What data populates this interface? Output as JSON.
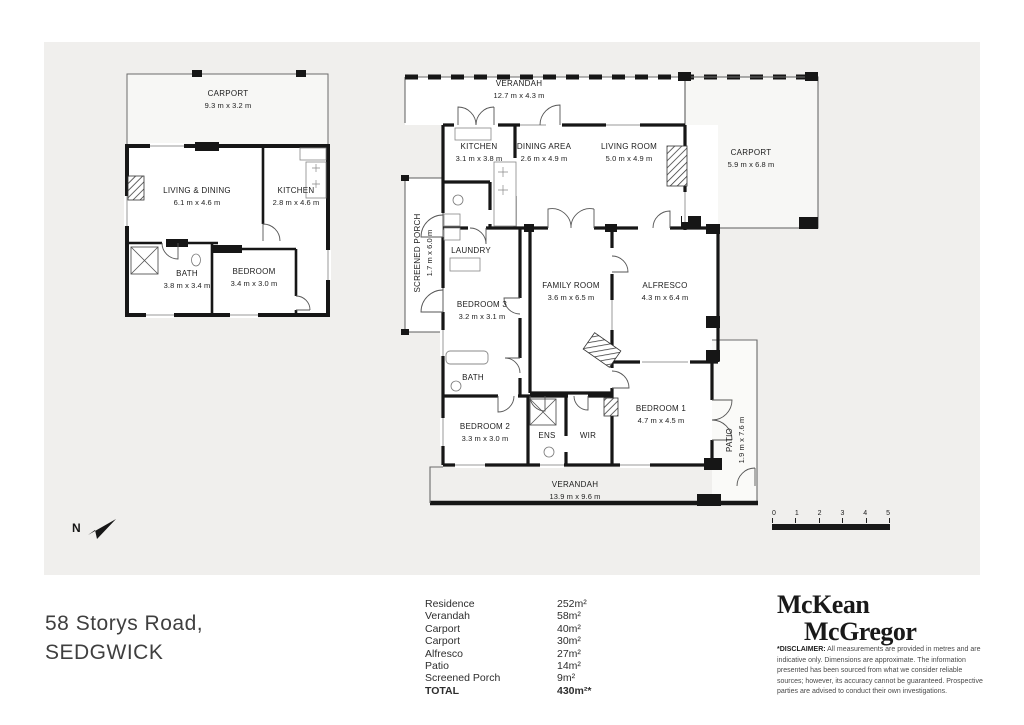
{
  "address": {
    "line1": "58 Storys Road,",
    "line2": "SEDGWICK"
  },
  "north": {
    "label": "N"
  },
  "scale_bar": {
    "ticks": [
      "0",
      "1",
      "2",
      "3",
      "4",
      "5"
    ]
  },
  "granny_flat": {
    "rooms": {
      "carport": {
        "name": "CARPORT",
        "dims": "9.3 m x 3.2 m"
      },
      "living_dining": {
        "name": "LIVING & DINING",
        "dims": "6.1 m x 4.6 m"
      },
      "kitchen": {
        "name": "KITCHEN",
        "dims": "2.8 m x 4.6 m"
      },
      "bath": {
        "name": "BATH",
        "dims": "3.8 m x 3.4 m"
      },
      "bedroom": {
        "name": "BEDROOM",
        "dims": "3.4 m x 3.0 m"
      }
    }
  },
  "main_house": {
    "rooms": {
      "verandah_top": {
        "name": "VERANDAH",
        "dims": "12.7 m x 4.3 m"
      },
      "kitchen": {
        "name": "KITCHEN",
        "dims": "3.1 m x 3.8 m"
      },
      "dining_area": {
        "name": "DINING AREA",
        "dims": "2.6 m x 4.9 m"
      },
      "living_room": {
        "name": "LIVING ROOM",
        "dims": "5.0 m x 4.9 m"
      },
      "carport": {
        "name": "CARPORT",
        "dims": "5.9 m x 6.8 m"
      },
      "screened_porch": {
        "name": "SCREENED PORCH",
        "dims": "1.7 m x 6.0 m"
      },
      "laundry": {
        "name": "LAUNDRY",
        "dims": ""
      },
      "family_room": {
        "name": "FAMILY ROOM",
        "dims": "3.6 m x 6.5 m"
      },
      "alfresco": {
        "name": "ALFRESCO",
        "dims": "4.3 m x 6.4 m"
      },
      "bedroom3": {
        "name": "BEDROOM 3",
        "dims": "3.2 m x 3.1 m"
      },
      "bath": {
        "name": "BATH",
        "dims": ""
      },
      "bedroom2": {
        "name": "BEDROOM 2",
        "dims": "3.3 m x 3.0 m"
      },
      "ens": {
        "name": "ENS",
        "dims": ""
      },
      "wir": {
        "name": "WIR",
        "dims": ""
      },
      "bedroom1": {
        "name": "BEDROOM 1",
        "dims": "4.7 m x 4.5 m"
      },
      "patio": {
        "name": "PATIO",
        "dims": "1.9 m x 7.6 m"
      },
      "verandah_bottom": {
        "name": "VERANDAH",
        "dims": "13.9 m x 9.6 m"
      }
    }
  },
  "area_table": {
    "rows": [
      {
        "label": "Residence",
        "value": "252m²"
      },
      {
        "label": "Verandah",
        "value": "58m²"
      },
      {
        "label": "Carport",
        "value": "40m²"
      },
      {
        "label": "Carport",
        "value": "30m²"
      },
      {
        "label": "Alfresco",
        "value": "27m²"
      },
      {
        "label": "Patio",
        "value": "14m²"
      },
      {
        "label": "Screened Porch",
        "value": "9m²"
      }
    ],
    "total": {
      "label": "TOTAL",
      "value": "430m²*"
    }
  },
  "branding": {
    "logo_line1": "McKean",
    "logo_line2": "McGregor"
  },
  "disclaimer": {
    "title": "*DISCLAIMER:",
    "text": " All measurements are provided in metres and are indicative only. Dimensions are approximate. The information presented has been sourced from what we consider reliable sources; however, its accuracy cannot be guaranteed. Prospective parties are advised to conduct their own investigations."
  }
}
